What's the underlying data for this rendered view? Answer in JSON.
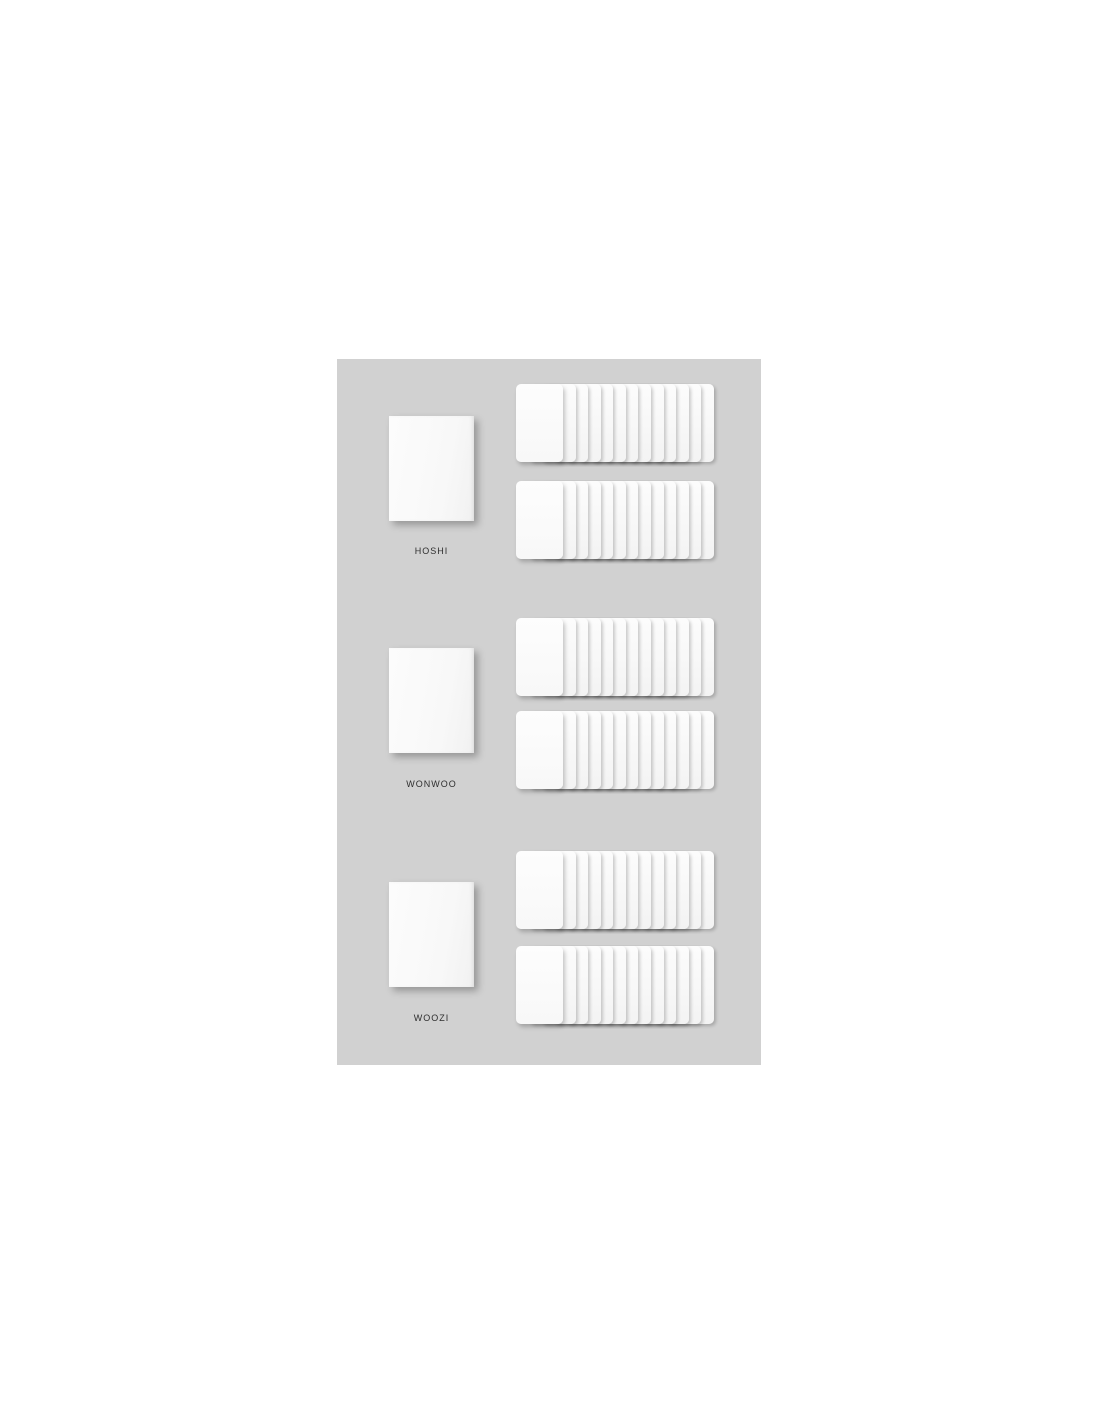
{
  "product": {
    "type": "photocard-set-mockup",
    "panel_background": "#d1d1d1",
    "page_background": "#ffffff",
    "card_color": "#f9f9f9",
    "label_color": "#2e2e2e",
    "members": [
      {
        "name": "HOSHI",
        "poster_count": 1,
        "rows": [
          {
            "cards": 13
          },
          {
            "cards": 13
          }
        ]
      },
      {
        "name": "WONWOO",
        "poster_count": 1,
        "rows": [
          {
            "cards": 13
          },
          {
            "cards": 13
          }
        ]
      },
      {
        "name": "WOOZI",
        "poster_count": 1,
        "rows": [
          {
            "cards": 13
          },
          {
            "cards": 13
          }
        ]
      }
    ]
  }
}
